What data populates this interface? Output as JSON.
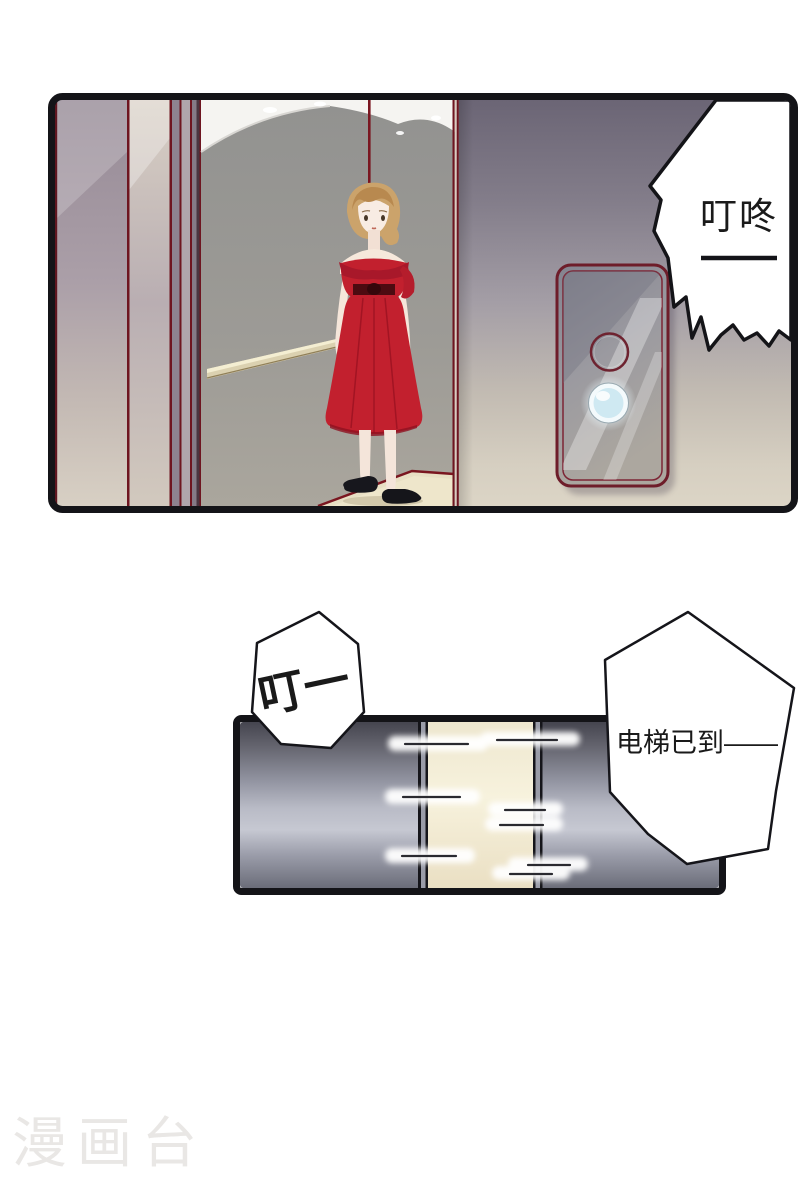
{
  "page": {
    "background": "#ffffff",
    "watermark": "漫画台"
  },
  "panel_interior": {
    "description": "elevator interior, woman in red off-shoulder dress, call-button panel on wall",
    "bubble_text": "叮咚",
    "bubble_dash": "——"
  },
  "panel_doors": {
    "description": "elevator doors sliding open with motion streaks",
    "sfx_text": "叮一",
    "bubble_text": "电梯已到——"
  },
  "colors": {
    "outline": "#141418",
    "dress_red": "#c2202e",
    "trim_dark_red": "#6e1d2a",
    "door_metal_bright": "#c6c8d2",
    "door_metal_dark": "#45454f",
    "door_gap_light": "#f7f2dd",
    "lit_button_glow": "#d6ecf2",
    "hall_wall_top": "#6b6575",
    "hall_wall_bottom": "#dcd5c6",
    "watermark_gray": "#e9e7e5"
  }
}
